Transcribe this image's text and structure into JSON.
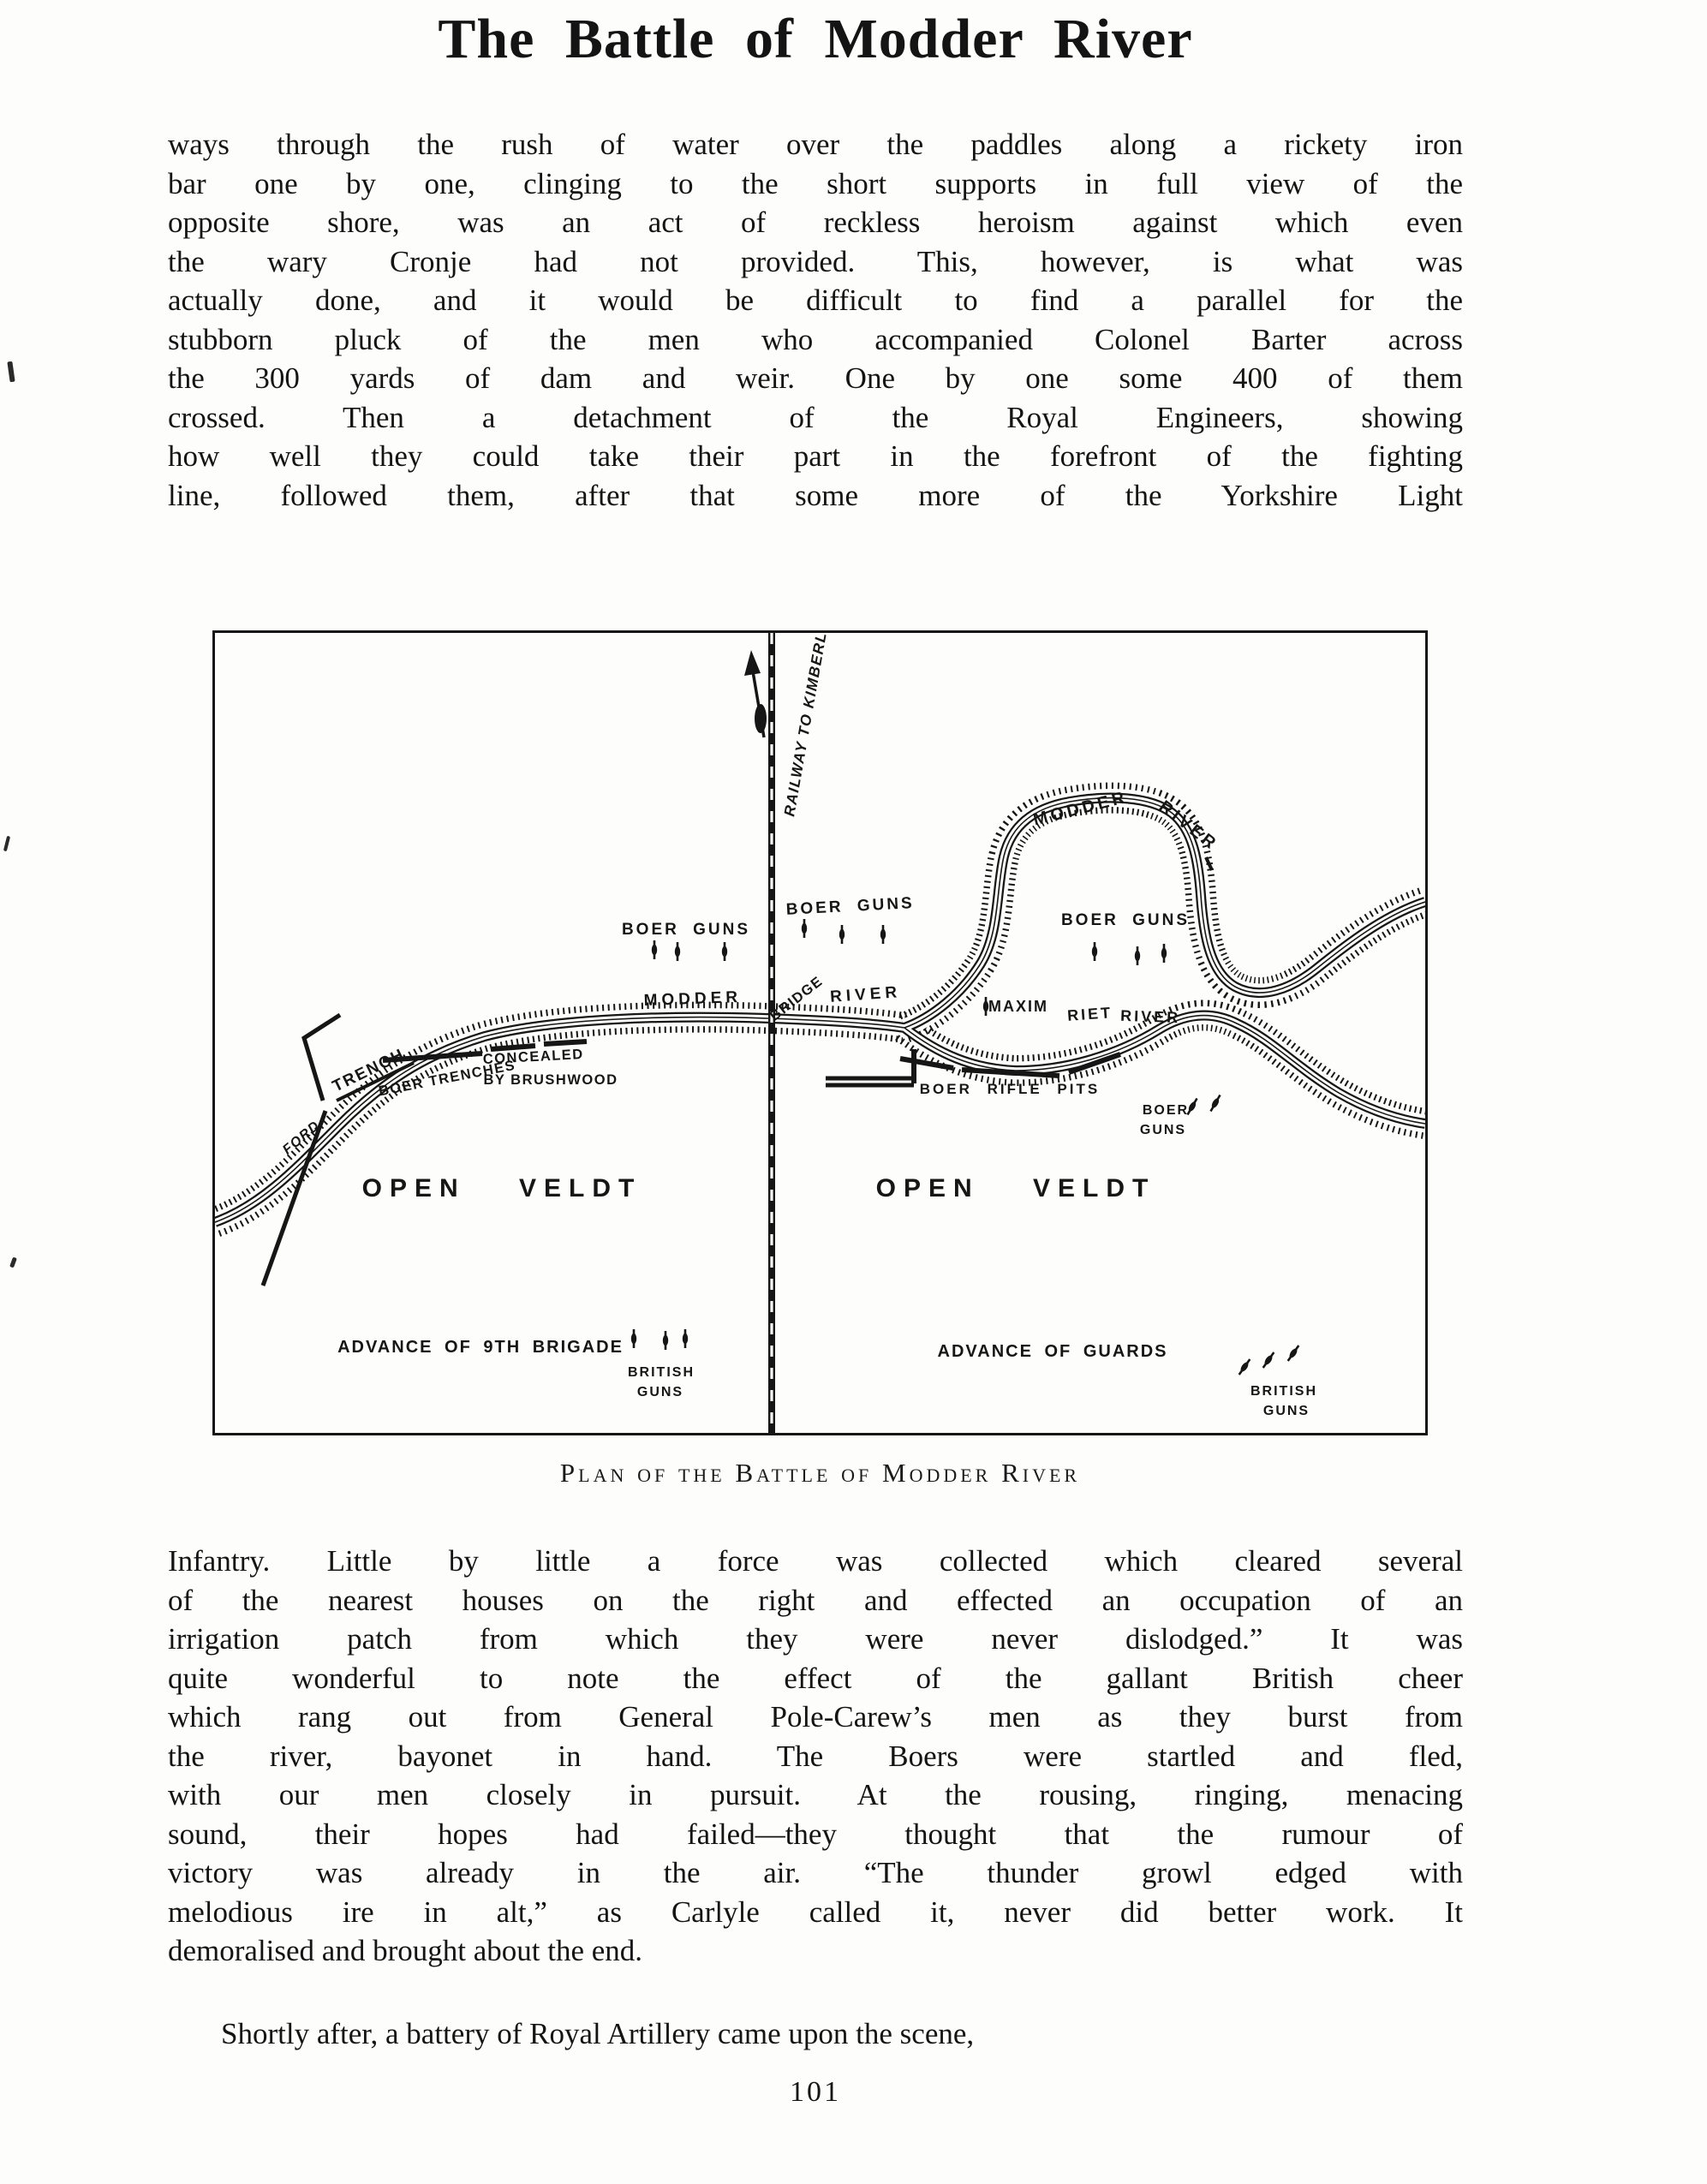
{
  "page": {
    "title": "The Battle of Modder River",
    "page_number": "101"
  },
  "body": {
    "paragraph1_lines": [
      "ways through the rush of water over the paddles along a rickety iron",
      "bar one by one, clinging to the short supports in full view of the",
      "opposite shore, was an act of reckless heroism against which even",
      "the wary Cronje had not provided.  This, however, is what was",
      "actually done, and it would be difficult to find a parallel for the",
      "stubborn pluck of the men who accompanied Colonel Barter across",
      "the 300 yards of dam and weir.  One by one some 400 of them",
      "crossed.  Then a detachment of the Royal Engineers, showing",
      "how well they could take their part in the forefront of the fighting",
      "line, followed them, after that some more of the Yorkshire Light"
    ],
    "paragraph2_lines": [
      "Infantry.  Little by little a force was collected which cleared several",
      "of the nearest houses on the right and effected an occupation of an",
      "irrigation patch from which they were never dislodged.”  It was",
      "quite wonderful to note the effect of the gallant British cheer",
      "which rang out from General Pole-Carew’s men as they burst from",
      "the river, bayonet in hand.  The Boers were startled and fled,",
      "with our men closely in pursuit.  At the rousing, ringing, menacing",
      "sound, their hopes had failed—they thought that the rumour of",
      "victory was already in the air.  “The thunder growl edged with",
      "melodious ire in alt,” as Carlyle called it, never did better work.  It",
      "demoralised and brought about the end."
    ],
    "paragraph3_lines": [
      "Shortly after, a battery of Royal Artillery came upon the scene,"
    ]
  },
  "figure": {
    "caption": "Plan of the Battle of Modder River",
    "map": {
      "railway_label": "RAILWAY TO KIMBERLEY",
      "modder_top_word1": "MODDER",
      "modder_top_word2": "RIVER",
      "boer_guns_left": "BOER GUNS",
      "boer_guns_center": "BOER GUNS",
      "boer_guns_loop": "BOER GUNS",
      "modder_mid": "MODDER",
      "bridge": "BRIDGE",
      "river_mid": "RIVER",
      "maxim": "MAXIM",
      "riet_word1": "RIET",
      "riet_word2": "RIVER",
      "trench": "TRENCH",
      "ford": "FORD",
      "boer_trenches_line1": "BOER TRENCHES",
      "boer_trenches_line2": "CONCEALED",
      "boer_trenches_line3": "BY BRUSHWOOD",
      "boer_rifle_pits": "BOER RIFLE PITS",
      "boer_guns_right_line1": "BOER",
      "boer_guns_right_line2": "GUNS",
      "open_veldt_left": "OPEN VELDT",
      "open_veldt_right": "OPEN VELDT",
      "advance_brigade": "ADVANCE OF 9TH BRIGADE",
      "british_guns_left_line1": "BRITISH",
      "british_guns_left_line2": "GUNS",
      "advance_guards": "ADVANCE OF GUARDS",
      "british_guns_right_line1": "BRITISH",
      "british_guns_right_line2": "GUNS"
    }
  },
  "colors": {
    "ink": "#161616",
    "paper": "#fdfdfb"
  }
}
